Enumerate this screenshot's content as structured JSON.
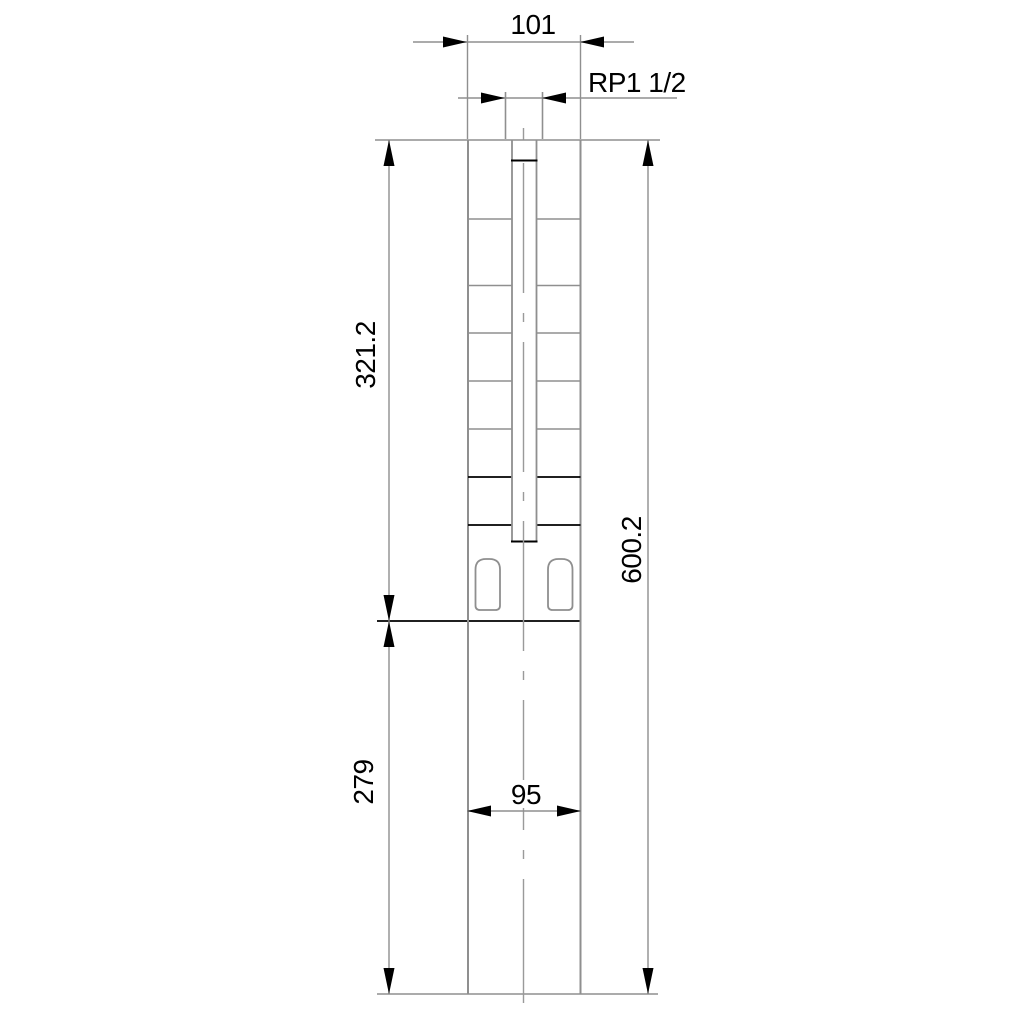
{
  "drawing": {
    "type": "technical-dimension-drawing",
    "subject": "submersible borehole pump outline with dimensions",
    "dimensions": {
      "top_outer_width": "101",
      "discharge_thread": "RP1 1/2",
      "upper_section_length": "321.2",
      "overall_length": "600.2",
      "lower_section_length": "279",
      "lower_section_width": "95"
    },
    "colors": {
      "background": "#ffffff",
      "line_grey": "#8f8f8f",
      "line_black": "#000000",
      "text": "#000000"
    }
  }
}
